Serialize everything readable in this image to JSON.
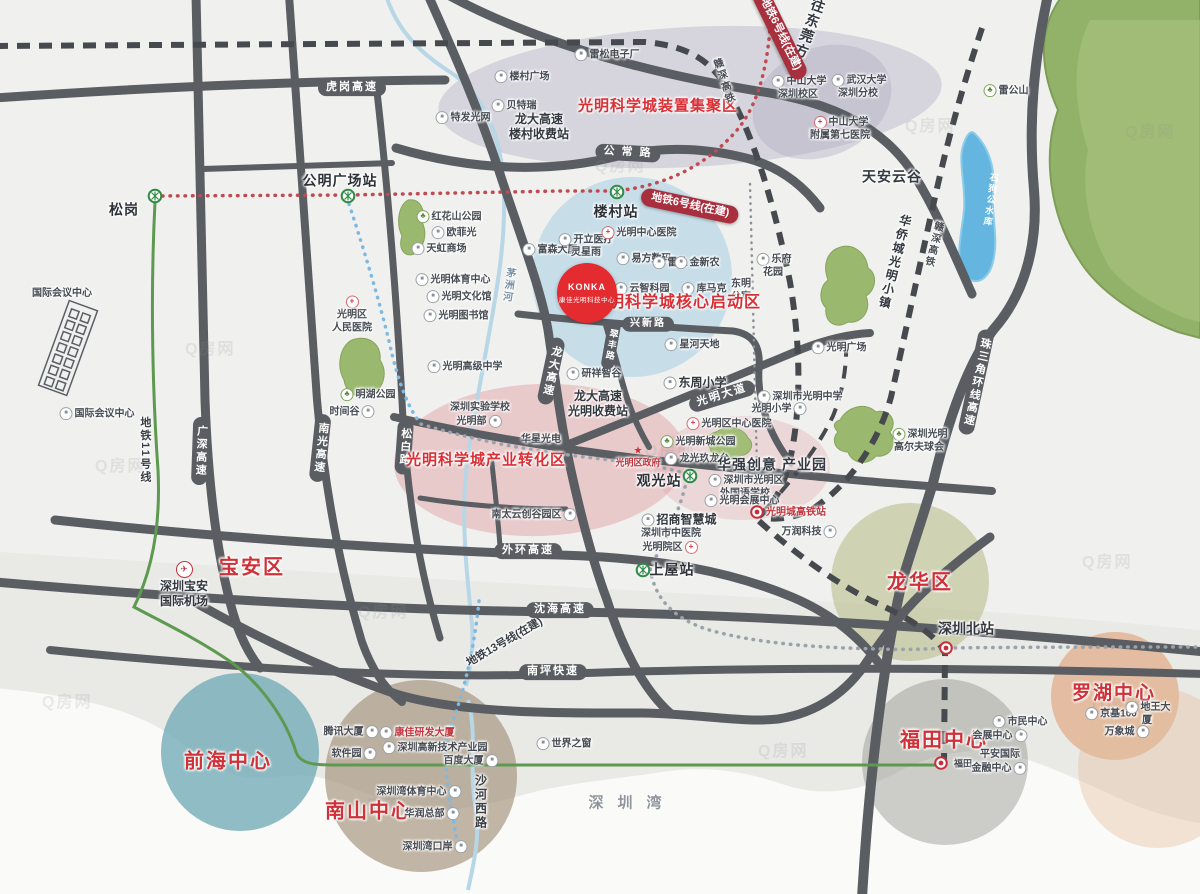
{
  "title": "光明科学城区位图",
  "watermark_text": "Q房网",
  "konka": {
    "logo": "KONKA",
    "name": "康佳光明科技中心"
  },
  "colors": {
    "road": "#5a5d62",
    "rail_dash": "#46494e",
    "metro6_red": "#c04a52",
    "metro_blue": "#7fb9e0",
    "metro_gray": "#9aa2ab",
    "line11_green": "#5d9950",
    "zone_red_text": "#d93036",
    "district_red": "#cf3138",
    "banner_red": "#a82f3d",
    "green_area": "#93b269",
    "lake_blue": "#64b6e0",
    "pink_zone": "#e2a0a6",
    "blue_zone": "#9ecbe4",
    "purple_zone": "#b2aec4"
  },
  "watermarks": [
    {
      "x": 185,
      "y": 335
    },
    {
      "x": 595,
      "y": 152
    },
    {
      "x": 905,
      "y": 112
    },
    {
      "x": 1125,
      "y": 118
    },
    {
      "x": 95,
      "y": 452
    },
    {
      "x": 645,
      "y": 437
    },
    {
      "x": 1082,
      "y": 548
    },
    {
      "x": 358,
      "y": 598
    },
    {
      "x": 42,
      "y": 688
    },
    {
      "x": 352,
      "y": 792
    },
    {
      "x": 758,
      "y": 737
    },
    {
      "x": 1092,
      "y": 692
    }
  ],
  "labels": [
    {
      "name": "label-songgang",
      "t": "松岗",
      "x": 124,
      "y": 210,
      "c": "stn"
    },
    {
      "name": "metro-icon-songgang",
      "x": 155,
      "y": 196,
      "ic": "metro",
      "iconly": true
    },
    {
      "name": "label-gongming-square-station",
      "t": "公明广场站",
      "x": 340,
      "y": 181,
      "c": "stn"
    },
    {
      "name": "metro-icon-gongming",
      "x": 348,
      "y": 196,
      "ic": "metro",
      "iconly": true
    },
    {
      "name": "road-label-hugang-expwy",
      "t": "虎岗高速",
      "x": 352,
      "y": 88,
      "c": "road"
    },
    {
      "name": "label-intl-conference-center-top",
      "t": "国际会议中心",
      "x": 62,
      "y": 294,
      "c": "poi"
    },
    {
      "name": "label-intl-conference-center",
      "t": "国际会议中心",
      "x": 96,
      "y": 414,
      "c": "poi",
      "ic": "b"
    },
    {
      "name": "label-tefa-guangwang",
      "t": "特发光网",
      "x": 462,
      "y": 118,
      "c": "poi",
      "ic": "b"
    },
    {
      "name": "label-beiterui",
      "t": "贝特瑞",
      "x": 513,
      "y": 106,
      "c": "poi",
      "ic": "b"
    },
    {
      "name": "label-loucun-plaza",
      "t": "楼村广场",
      "x": 521,
      "y": 77,
      "c": "poi",
      "ic": "b"
    },
    {
      "name": "label-leisong-electronics",
      "t": "雷松电子厂",
      "x": 606,
      "y": 55,
      "c": "poi",
      "ic": "b"
    },
    {
      "name": "label-longda-loucun-toll",
      "t": "龙大高速\n楼村收费站",
      "x": 539,
      "y": 127,
      "c": "bigsm"
    },
    {
      "name": "label-zone-device-cluster",
      "t": "光明科学城装置集聚区",
      "x": 658,
      "y": 107,
      "c": "zone"
    },
    {
      "name": "road-label-gongchang",
      "t": "公 常 路",
      "x": 628,
      "y": 153,
      "c": "road",
      "r": 3
    },
    {
      "name": "label-zhongshan-univ",
      "t": "中山大学\n深圳校区",
      "x": 798,
      "y": 88,
      "c": "poi",
      "ic": "b"
    },
    {
      "name": "label-wuhan-univ",
      "t": "武汉大学\n深圳分校",
      "x": 858,
      "y": 87,
      "c": "poi",
      "ic": "b"
    },
    {
      "name": "label-zsu-7th-hospital",
      "t": "中山大学\n附属第七医院",
      "x": 840,
      "y": 129,
      "c": "poi",
      "ic": "hosp"
    },
    {
      "name": "label-tianan-cloud-valley",
      "t": "天安云谷",
      "x": 892,
      "y": 177,
      "c": "big"
    },
    {
      "name": "label-leigongshan",
      "t": "雷公山",
      "x": 1005,
      "y": 91,
      "c": "poi",
      "ic": "park"
    },
    {
      "name": "label-shigougong-reservoir",
      "t": "石狗公水库",
      "x": 990,
      "y": 200,
      "c": "water vtext",
      "r": 8
    },
    {
      "name": "label-to-dongguan",
      "t": "往东莞方向",
      "x": 806,
      "y": 36,
      "c": "big vtext",
      "r": 20
    },
    {
      "name": "banner-metro6-northeast",
      "t": "地铁6号线(在建)",
      "x": 780,
      "y": 34,
      "c": "banner",
      "r": 64
    },
    {
      "name": "label-ganshen-hsr-north",
      "t": "赣深高铁",
      "x": 722,
      "y": 82,
      "c": "rail vtext",
      "r": -18
    },
    {
      "name": "banner-metro6-loucun",
      "t": "地铁6号线(在建)",
      "x": 690,
      "y": 206,
      "c": "banner",
      "r": 12
    },
    {
      "name": "label-loucun-station",
      "t": "楼村站",
      "x": 616,
      "y": 212,
      "c": "stn"
    },
    {
      "name": "metro-icon-loucun",
      "x": 617,
      "y": 192,
      "ic": "metro",
      "iconly": true
    },
    {
      "name": "label-honghuashan-park",
      "t": "红花山公园",
      "x": 448,
      "y": 217,
      "c": "poi",
      "ic": "park"
    },
    {
      "name": "label-oufeiguang",
      "t": "欧菲光",
      "x": 453,
      "y": 233,
      "c": "poi",
      "ic": "b"
    },
    {
      "name": "label-tianhong-mall",
      "t": "天虹商场",
      "x": 438,
      "y": 249,
      "c": "poi",
      "ic": "b"
    },
    {
      "name": "label-guangming-sports-center",
      "t": "光明体育中心",
      "x": 452,
      "y": 280,
      "c": "poi",
      "ic": "b"
    },
    {
      "name": "label-guangming-culture-hall",
      "t": "光明文化馆",
      "x": 458,
      "y": 297,
      "c": "poi",
      "ic": "b"
    },
    {
      "name": "label-guangming-library",
      "t": "光明图书馆",
      "x": 455,
      "y": 316,
      "c": "poi",
      "ic": "b"
    },
    {
      "name": "label-guangming-high-school",
      "t": "光明高级中学",
      "x": 464,
      "y": 367,
      "c": "poi",
      "ic": "b"
    },
    {
      "name": "label-maozhou-river",
      "t": "茅洲河",
      "x": 507,
      "y": 285,
      "c": "river vtext",
      "r": 8
    },
    {
      "name": "label-guangming-people-hospital",
      "t": "光明区\n人民医院",
      "x": 352,
      "y": 315,
      "c": "poi",
      "ic": "hosp",
      "ip": "top"
    },
    {
      "name": "label-minghu-park",
      "t": "明湖公园",
      "x": 367,
      "y": 395,
      "c": "poi",
      "ic": "park"
    },
    {
      "name": "label-time-valley",
      "t": "时间谷",
      "x": 353,
      "y": 412,
      "c": "poi",
      "ic": "b",
      "ip": "right"
    },
    {
      "name": "label-metro-line11",
      "t": "地铁11号线",
      "x": 144,
      "y": 450,
      "c": "mline vtext"
    },
    {
      "name": "road-label-guangshen-expwy",
      "t": "广深高速",
      "x": 200,
      "y": 451,
      "c": "roadv",
      "r": 2
    },
    {
      "name": "road-label-nanguang-expwy",
      "t": "南光高速",
      "x": 320,
      "y": 448,
      "c": "roadv",
      "r": 6
    },
    {
      "name": "road-label-songbai",
      "t": "松白路",
      "x": 404,
      "y": 447,
      "c": "roadv",
      "r": 4
    },
    {
      "name": "road-label-longda-expwy",
      "t": "龙大高速",
      "x": 551,
      "y": 371,
      "c": "roadv",
      "r": 12
    },
    {
      "name": "label-fusen-building",
      "t": "富森大厦",
      "x": 549,
      "y": 250,
      "c": "poi",
      "ic": "b"
    },
    {
      "name": "label-kaili-medical",
      "t": "开立医疗",
      "x": 585,
      "y": 240,
      "c": "poi",
      "ic": "b"
    },
    {
      "name": "label-lingxingyu",
      "t": "灵星雨",
      "x": 586,
      "y": 253,
      "c": "poi"
    },
    {
      "name": "label-guangming-center-hospital",
      "t": "光明中心医院",
      "x": 638,
      "y": 233,
      "c": "poi",
      "ic": "hosp"
    },
    {
      "name": "label-yifang-digital",
      "t": "易方数码",
      "x": 643,
      "y": 259,
      "c": "poi",
      "ic": "b"
    },
    {
      "name": "label-leidu",
      "t": "雷杜",
      "x": 669,
      "y": 263,
      "c": "poi",
      "ic": "b"
    },
    {
      "name": "label-jinxinnong",
      "t": "金新农",
      "x": 696,
      "y": 263,
      "c": "poi",
      "ic": "b"
    },
    {
      "name": "label-yunzhi-park",
      "t": "云智科园",
      "x": 641,
      "y": 289,
      "c": "poi",
      "ic": "b"
    },
    {
      "name": "label-kumake",
      "t": "库马克",
      "x": 703,
      "y": 289,
      "c": "poi",
      "ic": "b"
    },
    {
      "name": "label-dongming-apartment",
      "t": "东明\n公寓",
      "x": 741,
      "y": 291,
      "c": "poi"
    },
    {
      "name": "label-lefu-garden",
      "t": "乐府\n花园",
      "x": 773,
      "y": 266,
      "c": "poi",
      "ic": "b"
    },
    {
      "name": "label-zone-core-startup",
      "t": "光明科学城核心启动区",
      "x": 676,
      "y": 303,
      "c": "zone",
      "fs": 16
    },
    {
      "name": "road-label-xingxin",
      "t": "兴新路",
      "x": 648,
      "y": 324,
      "c": "road",
      "fs": 10
    },
    {
      "name": "label-xinghe-tiandi",
      "t": "星河天地",
      "x": 691,
      "y": 345,
      "c": "poi",
      "ic": "b"
    },
    {
      "name": "label-yanxiang-valley",
      "t": "研祥智谷",
      "x": 593,
      "y": 374,
      "c": "poi",
      "ic": "b"
    },
    {
      "name": "label-dongzhou-primary-school",
      "t": "东周小学",
      "x": 694,
      "y": 383,
      "c": "bigsm",
      "ic": "b"
    },
    {
      "name": "road-label-cuifeng",
      "t": "翠丰路",
      "x": 611,
      "y": 345,
      "c": "roadv",
      "fs": 9,
      "r": 10
    },
    {
      "name": "road-label-guangming-avenue",
      "t": "光明大道",
      "x": 722,
      "y": 396,
      "c": "road",
      "r": -17
    },
    {
      "name": "label-guangming-middle-school",
      "t": "深圳市光明中学",
      "x": 799,
      "y": 397,
      "c": "poi",
      "ic": "b"
    },
    {
      "name": "label-guangming-primary-school",
      "t": "光明小学",
      "x": 780,
      "y": 409,
      "c": "poi",
      "ic": "b",
      "ip": "right"
    },
    {
      "name": "label-guangming-plaza",
      "t": "光明广场",
      "x": 838,
      "y": 348,
      "c": "poi",
      "ic": "b"
    },
    {
      "name": "label-oct-guangming-town",
      "t": "华侨城光明小镇",
      "x": 894,
      "y": 262,
      "c": "bigsm vtext",
      "r": 14
    },
    {
      "name": "label-ganshen-hsr-east",
      "t": "赣深高铁",
      "x": 932,
      "y": 244,
      "c": "rail vtext",
      "r": 14
    },
    {
      "name": "road-label-zhusanjiao-expwy",
      "t": "珠三角环线高速",
      "x": 976,
      "y": 382,
      "c": "roadv",
      "r": 12
    },
    {
      "name": "label-shenzhen-experimental-school",
      "t": "深圳实验学校\n光明部",
      "x": 480,
      "y": 415,
      "c": "poi",
      "ic": "b",
      "ip": "right"
    },
    {
      "name": "label-huaxing-optoelectronics",
      "t": "华星光电",
      "x": 541,
      "y": 440,
      "c": "poi"
    },
    {
      "name": "label-zone-industry-transform",
      "t": "光明科学城产业转化区",
      "x": 486,
      "y": 461,
      "c": "zone"
    },
    {
      "name": "label-longda-guangming-toll",
      "t": "龙大高速\n光明收费站",
      "x": 598,
      "y": 404,
      "c": "bigsm"
    },
    {
      "name": "label-guangming-government",
      "t": "光明区政府",
      "x": 638,
      "y": 457,
      "c": "poi sm poired",
      "ic": "star",
      "ip": "top"
    },
    {
      "name": "label-guanguang-station",
      "t": "观光站",
      "x": 659,
      "y": 481,
      "c": "stn"
    },
    {
      "name": "metro-icon-guanguang",
      "x": 690,
      "y": 476,
      "ic": "metro",
      "iconly": true
    },
    {
      "name": "label-guangming-district-hospital",
      "t": "光明区中心医院",
      "x": 728,
      "y": 424,
      "c": "poi",
      "ic": "hosp"
    },
    {
      "name": "label-guangming-newtown-park",
      "t": "光明新城公园",
      "x": 697,
      "y": 442,
      "c": "poi",
      "ic": "park"
    },
    {
      "name": "label-longguang-jiulongtai",
      "t": "龙光玖龙台",
      "x": 696,
      "y": 459,
      "c": "poi",
      "ic": "b"
    },
    {
      "name": "label-huaqiang-creative-park",
      "t": "华强创意  产业园",
      "x": 772,
      "y": 465,
      "c": "big"
    },
    {
      "name": "label-foreign-language-school",
      "t": "深圳市光明区\n外国语学校",
      "x": 745,
      "y": 487,
      "c": "poi",
      "ic": "b"
    },
    {
      "name": "label-guangming-expo-center",
      "t": "光明会展中心",
      "x": 741,
      "y": 501,
      "c": "poi",
      "ic": "b"
    },
    {
      "name": "label-guangmingcheng-hsr-station",
      "t": "光明城高铁站",
      "x": 796,
      "y": 513,
      "c": "poi poired"
    },
    {
      "name": "rail-icon-guangmingcheng",
      "x": 757,
      "y": 512,
      "ic": "rail",
      "iconly": true
    },
    {
      "name": "label-wanrun-tech",
      "t": "万润科技",
      "x": 810,
      "y": 532,
      "c": "poi",
      "ic": "b",
      "ip": "right"
    },
    {
      "name": "label-zhaoshang-smartcity",
      "t": "招商智慧城",
      "x": 678,
      "y": 520,
      "c": "bigsm",
      "ic": "b"
    },
    {
      "name": "label-tcm-hospital-guangming",
      "t": "深圳市中医院\n光明院区",
      "x": 671,
      "y": 541,
      "c": "poi",
      "ic": "hosp",
      "ip": "right"
    },
    {
      "name": "label-nantai-cloud-valley",
      "t": "南太云创谷园区",
      "x": 535,
      "y": 515,
      "c": "poi",
      "ic": "b",
      "ip": "right"
    },
    {
      "name": "label-shangwu-station",
      "t": "上屋站",
      "x": 672,
      "y": 570,
      "c": "stn"
    },
    {
      "name": "metro-icon-shangwu",
      "x": 643,
      "y": 570,
      "ic": "metro",
      "iconly": true
    },
    {
      "name": "road-label-waihuan-expwy",
      "t": "外环高速",
      "x": 528,
      "y": 551,
      "c": "road"
    },
    {
      "name": "label-guangming-golf-club",
      "t": "深圳光明\n高尔夫球会",
      "x": 919,
      "y": 441,
      "c": "poi",
      "ic": "park"
    },
    {
      "name": "label-baoan-district",
      "t": "宝安区",
      "x": 252,
      "y": 568,
      "c": "dist"
    },
    {
      "name": "label-baoan-airport",
      "t": "深圳宝安\n国际机场",
      "x": 184,
      "y": 585,
      "c": "bigsm",
      "ic": "plane",
      "ip": "top"
    },
    {
      "name": "label-metro-line13",
      "t": "地铁13号线(在建)",
      "x": 505,
      "y": 643,
      "c": "mline",
      "r": -30
    },
    {
      "name": "label-qianhai-center",
      "t": "前海中心",
      "x": 228,
      "y": 762,
      "c": "dist"
    },
    {
      "name": "label-nanshan-center",
      "t": "南山中心",
      "x": 369,
      "y": 812,
      "c": "dist"
    },
    {
      "name": "label-tencent-building",
      "t": "腾讯大厦",
      "x": 352,
      "y": 732,
      "c": "poi",
      "ic": "b",
      "ip": "right"
    },
    {
      "name": "label-konka-rd-building",
      "t": "康佳研发大厦",
      "x": 416,
      "y": 733,
      "c": "poi poired",
      "ic": "b"
    },
    {
      "name": "label-software-park",
      "t": "软件园",
      "x": 355,
      "y": 754,
      "c": "poi",
      "ic": "b",
      "ip": "right"
    },
    {
      "name": "label-hightech-park",
      "t": "深圳高新技术产业园",
      "x": 434,
      "y": 748,
      "c": "poi",
      "ic": "b"
    },
    {
      "name": "label-baidu-building",
      "t": "百度大厦",
      "x": 472,
      "y": 761,
      "c": "poi",
      "ic": "b",
      "ip": "right"
    },
    {
      "name": "label-window-of-world",
      "t": "世界之窗",
      "x": 563,
      "y": 744,
      "c": "poi",
      "ic": "b"
    },
    {
      "name": "label-szbay-sports-center",
      "t": "深圳湾体育中心",
      "x": 420,
      "y": 792,
      "c": "poi",
      "ic": "b",
      "ip": "right"
    },
    {
      "name": "label-huarun-hq",
      "t": "华润总部",
      "x": 433,
      "y": 814,
      "c": "poi",
      "ic": "b",
      "ip": "right"
    },
    {
      "name": "label-szbay-port",
      "t": "深圳湾口岸",
      "x": 436,
      "y": 847,
      "c": "poi",
      "ic": "b",
      "ip": "right"
    },
    {
      "name": "label-shahexi-road",
      "t": "沙河西路",
      "x": 480,
      "y": 802,
      "c": "mline vtext",
      "fs": 12
    },
    {
      "name": "label-shenzhen-bay",
      "t": "深圳湾",
      "x": 632,
      "y": 804,
      "c": "sea"
    },
    {
      "name": "label-longhua-district",
      "t": "龙华区",
      "x": 920,
      "y": 583,
      "c": "dist"
    },
    {
      "name": "label-shenzhen-north-station",
      "t": "深圳北站",
      "x": 966,
      "y": 629,
      "c": "bigsm poired",
      "fs": 14
    },
    {
      "name": "rail-icon-szbei",
      "x": 946,
      "y": 648,
      "ic": "rail",
      "iconly": true
    },
    {
      "name": "road-label-shenhai-expwy",
      "t": "沈海高速",
      "x": 560,
      "y": 610,
      "c": "road"
    },
    {
      "name": "road-label-nanping-expwy",
      "t": "南坪快速",
      "x": 553,
      "y": 672,
      "c": "road"
    },
    {
      "name": "label-futian-center",
      "t": "福田中心",
      "x": 944,
      "y": 741,
      "c": "dist"
    },
    {
      "name": "label-futian-station",
      "t": "福田",
      "x": 963,
      "y": 764,
      "c": "poi sm"
    },
    {
      "name": "rail-icon-futian",
      "x": 941,
      "y": 763,
      "ic": "rail",
      "iconly": true
    },
    {
      "name": "label-civic-center",
      "t": "市民中心",
      "x": 1019,
      "y": 722,
      "c": "poi",
      "ic": "b"
    },
    {
      "name": "label-convention-center",
      "t": "会展中心",
      "x": 1001,
      "y": 736,
      "c": "poi",
      "ic": "b",
      "ip": "right"
    },
    {
      "name": "label-pingan-finance-center",
      "t": "平安国际\n金融中心",
      "x": 1000,
      "y": 762,
      "c": "poi",
      "ic": "b",
      "ip": "right"
    },
    {
      "name": "label-luohu-center",
      "t": "罗湖中心",
      "x": 1114,
      "y": 694,
      "c": "dist",
      "fs": 19
    },
    {
      "name": "label-jingji-100",
      "t": "京基100",
      "x": 1110,
      "y": 714,
      "c": "poi",
      "ic": "b"
    },
    {
      "name": "label-diwang-building",
      "t": "地王大厦",
      "x": 1147,
      "y": 714,
      "c": "poi",
      "ic": "b"
    },
    {
      "name": "label-mixc-mall",
      "t": "万象城",
      "x": 1128,
      "y": 732,
      "c": "poi",
      "ic": "b",
      "ip": "right"
    }
  ]
}
